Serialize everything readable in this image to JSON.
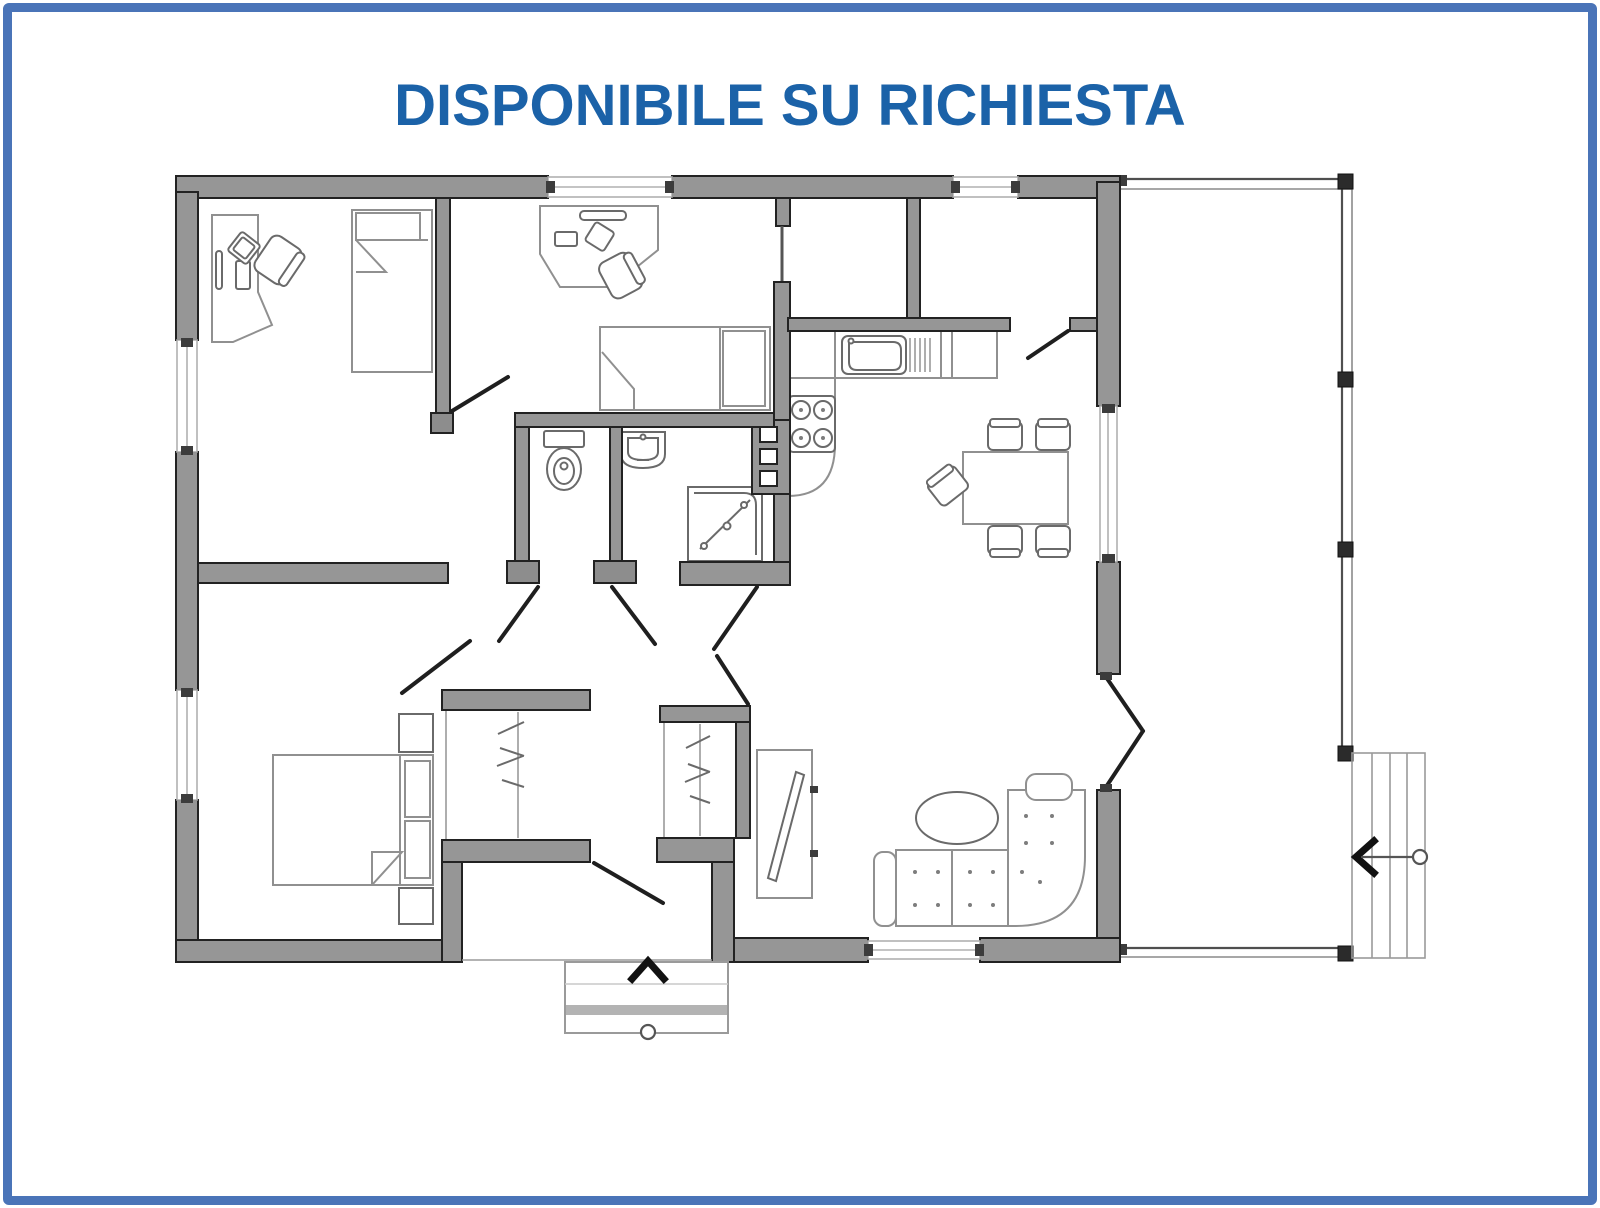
{
  "title": {
    "text": "DISPONIBILE SU RICHIESTA",
    "color": "#1b62a8"
  },
  "page": {
    "background": "#ffffff",
    "border_color": "#4a74b8"
  },
  "colors": {
    "wall_fill": "#969696",
    "wall_stroke": "#222222",
    "furniture_stroke": "#909090",
    "fixture_stroke": "#6a6a6a",
    "door_stroke": "#1f1f1f",
    "window_line": "#b0b0b0",
    "arrow": "#111111"
  },
  "floor_plan": {
    "type": "single-storey house plan",
    "rooms": [
      "study-bedroom",
      "bedroom",
      "wc",
      "shower-room",
      "kitchen",
      "dining-area",
      "living-area",
      "master-bedroom",
      "hallway",
      "entry",
      "porch"
    ],
    "furniture_icons": [
      "desk-icon",
      "office-chair-icon",
      "single-bed-icon",
      "double-bed-icon",
      "wardrobe-icon",
      "toilet-icon",
      "washbasin-icon",
      "shower-icon",
      "kitchen-sink-icon",
      "stove-icon",
      "service-shaft-icon",
      "dining-table-icon",
      "dining-chair-icon",
      "corner-sofa-icon",
      "coffee-table-icon",
      "tv-cabinet-icon",
      "steps-icon"
    ],
    "dining_chairs": 5,
    "symbols": [
      "entrance-direction-arrow",
      "porch-direction-arrow",
      "door-swing-lines",
      "window-openings",
      "porch-posts"
    ]
  }
}
